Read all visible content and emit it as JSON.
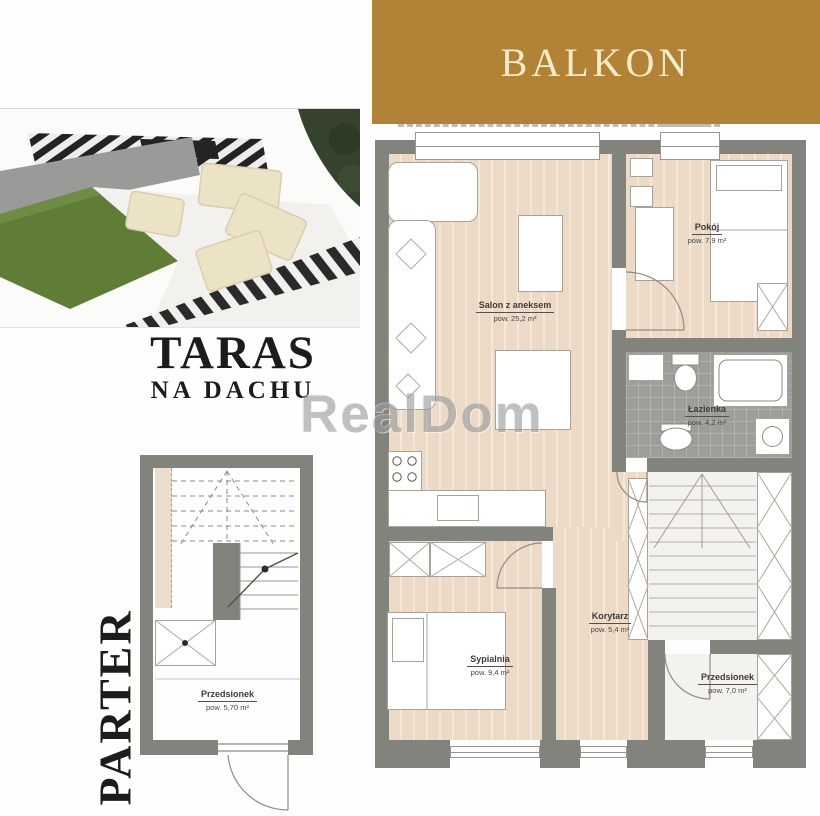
{
  "balcony": {
    "label": "BALKON"
  },
  "terrace_photo": {
    "caption_title": "TARAS",
    "caption_subtitle": "NA DACHU"
  },
  "watermark": {
    "text": "RealDom"
  },
  "ground_floor": {
    "label": "PARTER",
    "rooms": [
      {
        "name": "Przedsionek",
        "area": "pow. 5,70 m²"
      }
    ]
  },
  "upper_floor": {
    "rooms": [
      {
        "name": "Salon z aneksem",
        "area": "pow. 25,2 m²"
      },
      {
        "name": "Pokój",
        "area": "pow. 7,9 m²"
      },
      {
        "name": "Łazienka",
        "area": "pow. 4,2 m²"
      },
      {
        "name": "Korytarz",
        "area": "pow. 5,4 m²"
      },
      {
        "name": "Sypialnia",
        "area": "pow. 9,4 m²"
      },
      {
        "name": "Przedsionek",
        "area": "pow. 7,0 m²"
      }
    ]
  },
  "colors": {
    "banner_bg": "#b28336",
    "banner_text": "#f6ebc8",
    "wall": "#83837d",
    "wood_floor": "#ecd9c6",
    "bathroom_tile": "#9d9d99",
    "lawn": "#5f7d36",
    "watermark": "#9b9b9b"
  }
}
